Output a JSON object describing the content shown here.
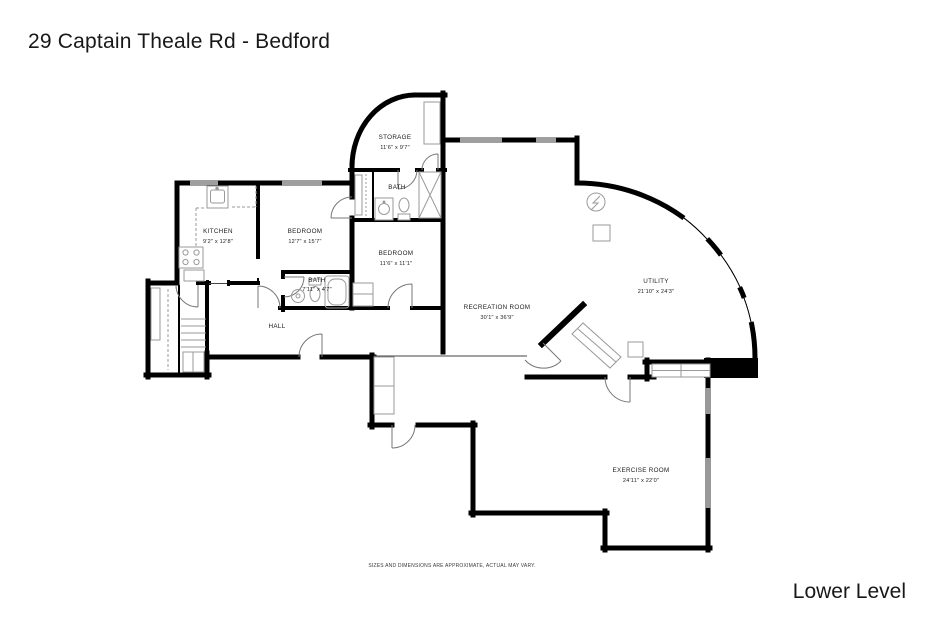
{
  "header": {
    "title": "29 Captain Theale Rd - Bedford"
  },
  "footer": {
    "level_label": "Lower Level",
    "disclaimer": "SIZES AND DIMENSIONS ARE APPROXIMATE, ACTUAL MAY VARY."
  },
  "colors": {
    "walls": "#000000",
    "background": "#ffffff",
    "fixtures": "#9a9a9a",
    "doors": "#8a8a8a",
    "text": "#1c1c1c"
  },
  "rooms": {
    "storage": {
      "name": "STORAGE",
      "dims": "11'6\" x 9'7\""
    },
    "bath_upper": {
      "name": "BATH",
      "dims": ""
    },
    "kitchen": {
      "name": "KITCHEN",
      "dims": "9'2\" x 12'8\""
    },
    "bedroom_left": {
      "name": "BEDROOM",
      "dims": "12'7\" x 15'7\""
    },
    "bedroom_right": {
      "name": "BEDROOM",
      "dims": "11'6\" x 11'1\""
    },
    "bath_lower": {
      "name": "BATH",
      "dims": "7'11\" x 4'7\""
    },
    "hall": {
      "name": "HALL",
      "dims": ""
    },
    "recreation": {
      "name": "RECREATION ROOM",
      "dims": "30'1\" x 36'9\""
    },
    "utility": {
      "name": "UTILITY",
      "dims": "21'10\" x 24'3\""
    },
    "exercise": {
      "name": "EXERCISE ROOM",
      "dims": "24'11\" x 22'0\""
    }
  }
}
